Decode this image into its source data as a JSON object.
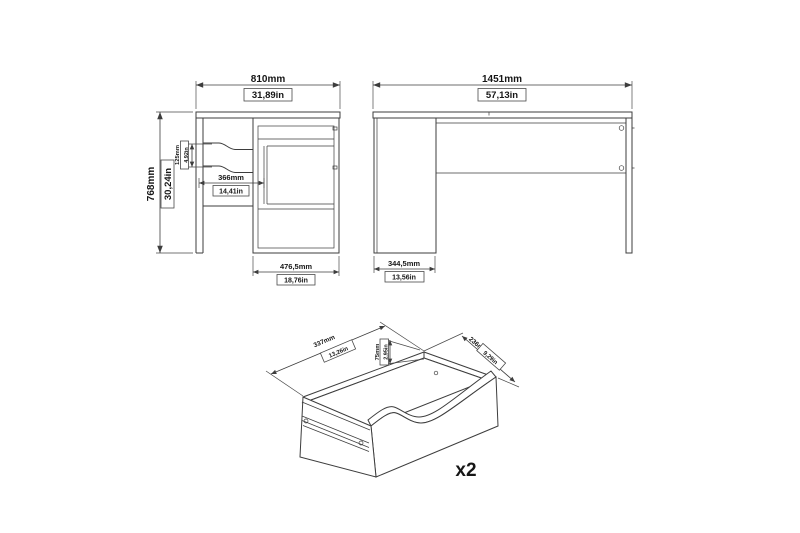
{
  "front_view": {
    "width_mm": "810mm",
    "width_in": "31,89in",
    "height_mm": "768mm",
    "height_in": "30,24in",
    "drawer_pitch_mm": "125mm",
    "drawer_pitch_in": "4,92in",
    "drawer_width_mm": "366mm",
    "drawer_width_in": "14,41in",
    "pedestal_width_mm": "476,5mm",
    "pedestal_width_in": "18,76in"
  },
  "side_view": {
    "length_mm": "1451mm",
    "length_in": "57,13in",
    "depth_mm": "344,5mm",
    "depth_in": "13,56in"
  },
  "drawer_detail": {
    "width_mm": "337mm",
    "width_in": "13,26in",
    "height_mm": "75mm",
    "height_in": "2,95in",
    "depth_mm": "236mm",
    "depth_in": "9,29in",
    "quantity_label": "x2"
  },
  "colors": {
    "line": "#3d3d3d",
    "text": "#161616",
    "background": "#ffffff"
  }
}
